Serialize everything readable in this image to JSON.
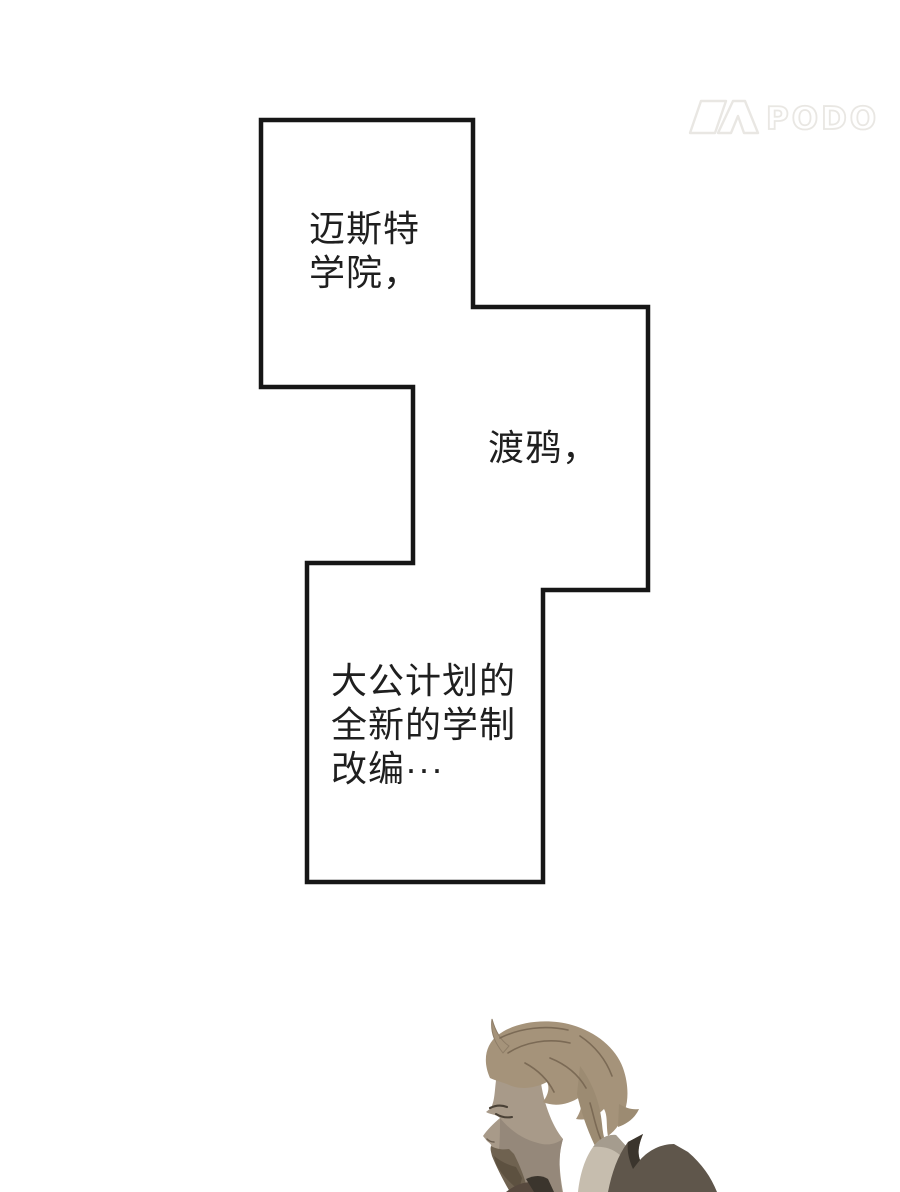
{
  "page": {
    "background_color": "#ffffff"
  },
  "watermark": {
    "icon": "podo-logo-icon",
    "text": "PODO",
    "color": "#eae8e5"
  },
  "speech_bubble": {
    "border_color": "#161616",
    "fill_color": "#ffffff",
    "text_color": "#1f1f1f",
    "text1": "迈斯特\n学院，",
    "text2": "渡鸦，",
    "text3": "大公计划的\n全新的学制\n改编···"
  },
  "illustration": {
    "name": "man-profile-portrait",
    "hair_color": "#a5937a",
    "face_color": "#a89a89",
    "beard_color": "#6f6250",
    "coat_color": "#5f564b",
    "collar_color": "#c6bdae"
  }
}
